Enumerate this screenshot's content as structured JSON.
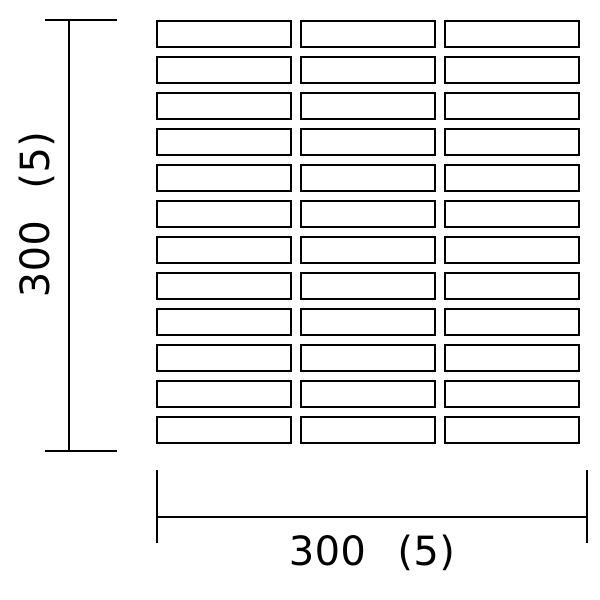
{
  "drawing": {
    "description": "Tile sheet layout dimension drawing",
    "background_color": "#ffffff",
    "line_color": "#000000",
    "tile_grid": {
      "rows": 12,
      "columns": 3,
      "tile_fill": "#ffffff",
      "tile_border_color": "#000000"
    },
    "dimensions": {
      "vertical": {
        "label": "300 (5)"
      },
      "horizontal": {
        "label": "300 (5)"
      }
    }
  }
}
